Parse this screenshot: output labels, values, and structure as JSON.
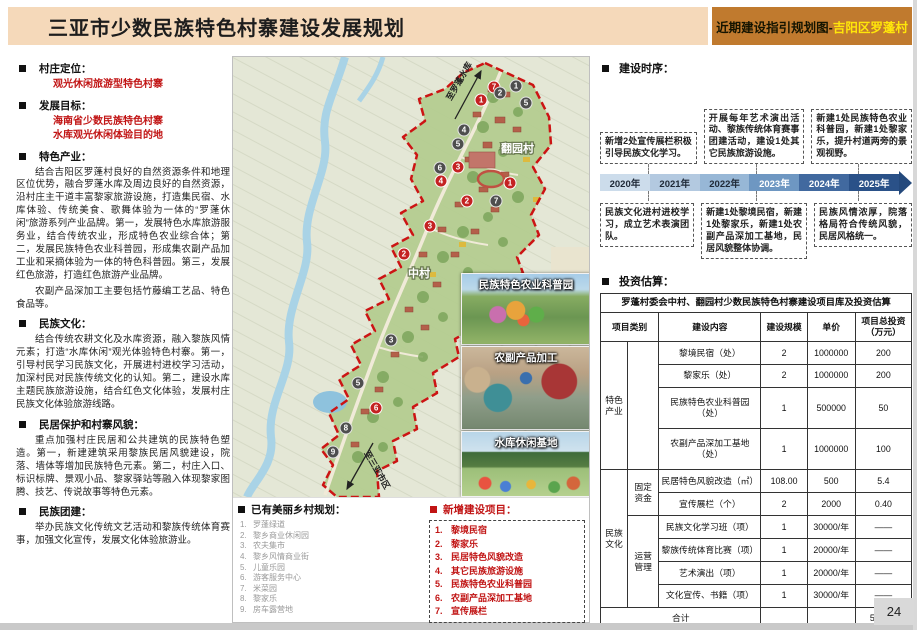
{
  "page": {
    "number": "24"
  },
  "header": {
    "title": "三亚市少数民族特色村寨建设发展规划",
    "subtitle_prefix": "近期建设指引规划图-",
    "subtitle_highlight": "吉阳区罗蓬村",
    "colors": {
      "left_bg": "#f5d9ba",
      "right_bg": "#c07a2e",
      "highlight_text": "#ffe60a",
      "accent_red": "#c11414"
    }
  },
  "left_panel": {
    "sections": [
      {
        "title": "村庄定位：",
        "red_lines": [
          "观光休闲旅游型特色村寨"
        ],
        "paragraphs": []
      },
      {
        "title": "发展目标：",
        "red_lines": [
          "海南省少数民族特色村寨",
          "水库观光休闲体验目的地"
        ],
        "paragraphs": []
      },
      {
        "title": "特色产业：",
        "red_lines": [],
        "paragraphs": [
          "结合吉阳区罗蓬村良好的自然资源条件和地理区位优势，融合罗蓬水库及周边良好的自然资源，沿村庄主干道丰富黎家旅游设施，打造集民宿、水库体验、传统美食、歌舞体验为一体的“罗蓬休闲”旅游系列产业品牌。第一，发展特色水库旅游服务业，结合传统农业，形成特色农业综合体；第二，发展民族特色农业科普园，形成集农副产品加工业和采摘体验为一体的特色科普园。第三，发展红色旅游，打造红色旅游产业品牌。",
          "农副产品深加工主要包括竹藤编工艺品、特色食品等。"
        ]
      },
      {
        "title": "民族文化：",
        "red_lines": [],
        "paragraphs": [
          "结合传统农耕文化及水库资源，融入黎族风情元素；打造“水库休闲”观光体验特色村寨。第一，引导村民学习民族文化，开展进村进校学习活动，加深村民对民族传统文化的认知。第二，建设水库主题民族旅游设施，结合红色文化体验，发展村庄民族文化体验旅游线路。"
        ]
      },
      {
        "title": "民居保护和村寨风貌：",
        "red_lines": [],
        "paragraphs": [
          "重点加强村庄民居和公共建筑的民族特色塑造。第一，新建建筑采用黎族民居风貌建设，院落、墙体等增加民族特色元素。第二，村庄入口、标识标牌、景观小品、黎家驿站等融入体现黎家图腾、技艺、传说故事等特色元素。"
        ]
      },
      {
        "title": "民族团建：",
        "red_lines": [],
        "paragraphs": [
          "举办民族文化传统文艺活动和黎族传统体育赛事，加强文化宣传，发展文化体验旅游业。"
        ]
      }
    ]
  },
  "map": {
    "labels": {
      "village_top": "翻园村",
      "village_bottom": "中村",
      "arrow_top": "至罗蓬水库",
      "arrow_bottom": "至三亚市区"
    },
    "photos": [
      {
        "caption": "民族特色农业科普园"
      },
      {
        "caption": "农副产品加工"
      },
      {
        "caption": "水库休闲基地"
      }
    ],
    "legend_existing": {
      "title": "已有美丽乡村规划：",
      "items": [
        "罗蓬绿道",
        "黎乡商业休闲园",
        "农夫集市",
        "黎乡风情商业街",
        "儿童乐园",
        "游客服务中心",
        "米菜园",
        "黎家乐",
        "房车露营地"
      ]
    },
    "legend_new": {
      "title": "新增建设项目：",
      "items": [
        "黎境民宿",
        "黎家乐",
        "民居特色风貌改造",
        "其它民族旅游设施",
        "民族特色农业科普园",
        "农副产品深加工基地",
        "宣传展栏"
      ]
    },
    "markers": [
      {
        "n": "7",
        "type": "new",
        "x": 73.3,
        "y": 6.8
      },
      {
        "n": "1",
        "type": "new",
        "x": 69.7,
        "y": 9.8
      },
      {
        "n": "3",
        "type": "new",
        "x": 63.2,
        "y": 25.0
      },
      {
        "n": "4",
        "type": "new",
        "x": 58.4,
        "y": 28.2
      },
      {
        "n": "1",
        "type": "new",
        "x": 77.8,
        "y": 28.6
      },
      {
        "n": "2",
        "type": "new",
        "x": 65.7,
        "y": 32.7
      },
      {
        "n": "3",
        "type": "new",
        "x": 55.3,
        "y": 38.4
      },
      {
        "n": "2",
        "type": "new",
        "x": 48.0,
        "y": 44.8
      },
      {
        "n": "6",
        "type": "new",
        "x": 40.2,
        "y": 79.8
      },
      {
        "n": "1",
        "type": "existing",
        "x": 79.5,
        "y": 6.6
      },
      {
        "n": "2",
        "type": "existing",
        "x": 75.0,
        "y": 8.2
      },
      {
        "n": "5",
        "type": "existing",
        "x": 82.3,
        "y": 10.5
      },
      {
        "n": "4",
        "type": "existing",
        "x": 64.9,
        "y": 16.6
      },
      {
        "n": "5",
        "type": "existing",
        "x": 63.2,
        "y": 19.8
      },
      {
        "n": "6",
        "type": "existing",
        "x": 58.1,
        "y": 25.2
      },
      {
        "n": "7",
        "type": "existing",
        "x": 73.9,
        "y": 32.7
      },
      {
        "n": "3",
        "type": "existing",
        "x": 44.4,
        "y": 64.3
      },
      {
        "n": "5",
        "type": "existing",
        "x": 35.1,
        "y": 74.1
      },
      {
        "n": "8",
        "type": "existing",
        "x": 31.7,
        "y": 84.3
      },
      {
        "n": "9",
        "type": "existing",
        "x": 28.1,
        "y": 89.8
      }
    ]
  },
  "timeline_section": {
    "heading": "建设时序：",
    "years": [
      "2020年",
      "2021年",
      "2022年",
      "2023年",
      "2024年",
      "2025年"
    ],
    "colors": [
      "#ccdceb",
      "#b3c9e0",
      "#97b7d6",
      "#6e97c2",
      "#41699f",
      "#2a5188"
    ],
    "top_boxes": [
      "新增2处宣传展栏积极引导民族文化学习。",
      "开展每年艺术演出活动、黎族传统体育赛事团建活动，建设1处其它民族旅游设施。",
      "新建1处民族特色农业科普园，新建1处黎家乐，提升村道两旁的景观视野。"
    ],
    "bottom_boxes": [
      "民族文化进村进校学习，成立艺术表演团队。",
      "新建1处黎境民宿，新建1处黎家乐，新建1处农副产品深加工基地，民居风貌整体协调。",
      "民族风情浓厚，院落格局符合传统风貌，民居风格统一。"
    ]
  },
  "investment": {
    "heading": "投资估算：",
    "table_title": "罗蓬村委会中村、翻园村少数民族特色村寨建设项目库及投资估算",
    "headers": {
      "cat": "项目类别",
      "content": "建设内容",
      "scale": "建设规模",
      "price": "单价",
      "total": "项目总投资（万元）"
    },
    "groups": [
      {
        "category": "特色产业",
        "subgroups": [
          {
            "label": "",
            "rows": [
              [
                "黎境民宿（处）",
                "2",
                "1000000",
                "200"
              ],
              [
                "黎家乐（处）",
                "2",
                "1000000",
                "200"
              ],
              [
                "民族特色农业科普园（处）",
                "1",
                "500000",
                "50"
              ],
              [
                "农副产品深加工基地（处）",
                "1",
                "1000000",
                "100"
              ]
            ]
          }
        ]
      },
      {
        "category": "民族文化",
        "subgroups": [
          {
            "label": "固定资金",
            "rows": [
              [
                "民居特色风貌改造（㎡）",
                "108.00",
                "500",
                "5.4"
              ],
              [
                "宣传展栏（个）",
                "2",
                "2000",
                "0.40"
              ]
            ]
          },
          {
            "label": "运营管理",
            "rows": [
              [
                "民族文化学习班（项）",
                "1",
                "30000/年",
                "——"
              ],
              [
                "黎族传统体育比赛（项）",
                "1",
                "20000/年",
                "——"
              ],
              [
                "艺术演出（项）",
                "1",
                "20000/年",
                "——"
              ],
              [
                "文化宣传、书籍（项）",
                "1",
                "30000/年",
                "——"
              ]
            ]
          }
        ]
      }
    ],
    "total": {
      "label": "合计",
      "value": "555.80"
    }
  }
}
